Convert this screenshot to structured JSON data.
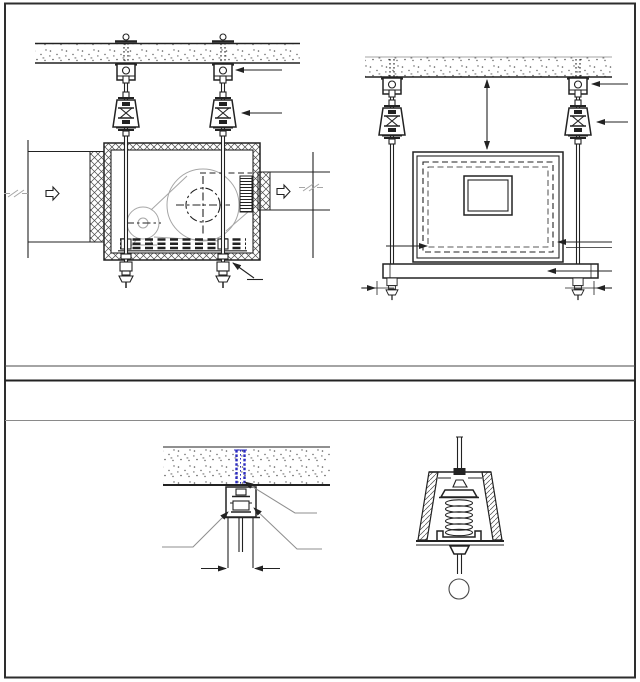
{
  "page": {
    "background": "#ffffff"
  },
  "colors": {
    "line": "#222222",
    "frame": "#2e2e2e",
    "light": "#a6a6a6",
    "leader": "#8f8f8f",
    "anchor_blue": "#2b2bc0",
    "hatch": "#4a4a4a",
    "stipple": "#5a5a5a",
    "bg": "#ffffff"
  },
  "figures": [
    {
      "name": "suspended-fan-unit-side-view"
    },
    {
      "name": "suspended-fan-unit-end-view"
    },
    {
      "name": "ceiling-anchor-fixing-detail"
    },
    {
      "name": "spring-vibration-isolator-detail"
    }
  ]
}
